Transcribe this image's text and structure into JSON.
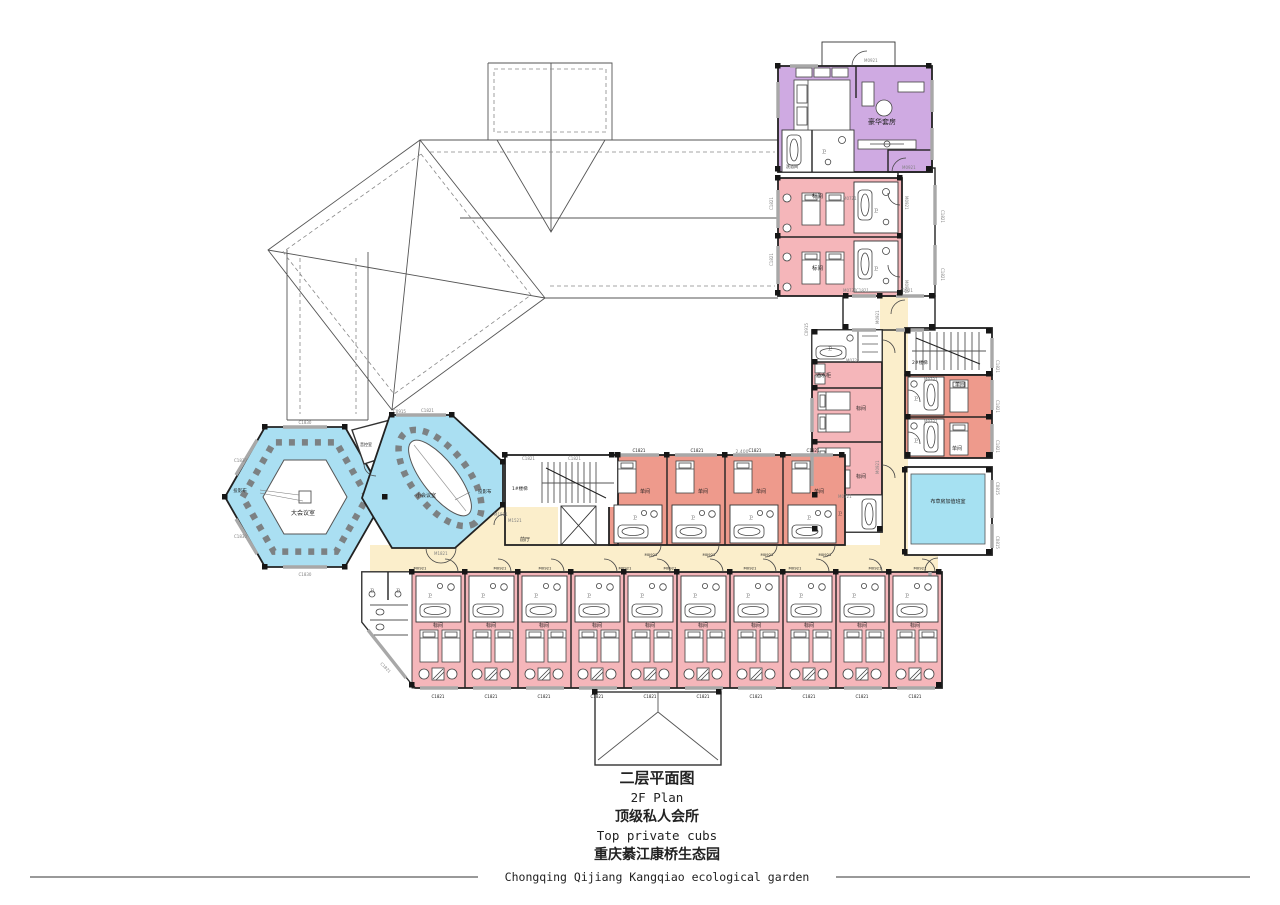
{
  "colors": {
    "standard_room": "#f5b6ba",
    "single_room": "#ee9a8c",
    "suite": "#cfaae2",
    "meeting_room": "#aadff2",
    "linen_room": "#a6e1f2",
    "corridor": "#fbeecb",
    "wall": "#222222",
    "window": "#a8a8a8"
  },
  "rooms": {
    "luxury_suite": "豪华套房",
    "shower_room": "洗浴间",
    "standard_room": "标间",
    "single_room": "单间",
    "bath": "卫",
    "bar_cabinet": "酒水柜",
    "stair_1": "1#楼梯",
    "stair_2": "2#楼梯",
    "front_hall": "前厅",
    "large_meeting": "大会议室",
    "small_meeting": "小会议室",
    "audio_control": "音控室",
    "projection_screen": "投影布",
    "linen_duty": "布草房加值班室"
  },
  "codes": {
    "c1821": "C1821",
    "c1830": "C1830",
    "c0915": "C0915",
    "c0815": "C0815",
    "m0921": "M0921",
    "m0721": "M0721",
    "m1521": "M1521",
    "m1821": "M1821"
  },
  "dimensions": {
    "d2400": "2,400"
  },
  "title_block": {
    "plan_title_zh": "二层平面图",
    "plan_title_en": "2F Plan",
    "subtitle_zh": "顶级私人会所",
    "subtitle_en": "Top private cubs",
    "project_zh": "重庆綦江康桥生态园",
    "project_en": "Chongqing Qijiang Kangqiao ecological garden"
  }
}
